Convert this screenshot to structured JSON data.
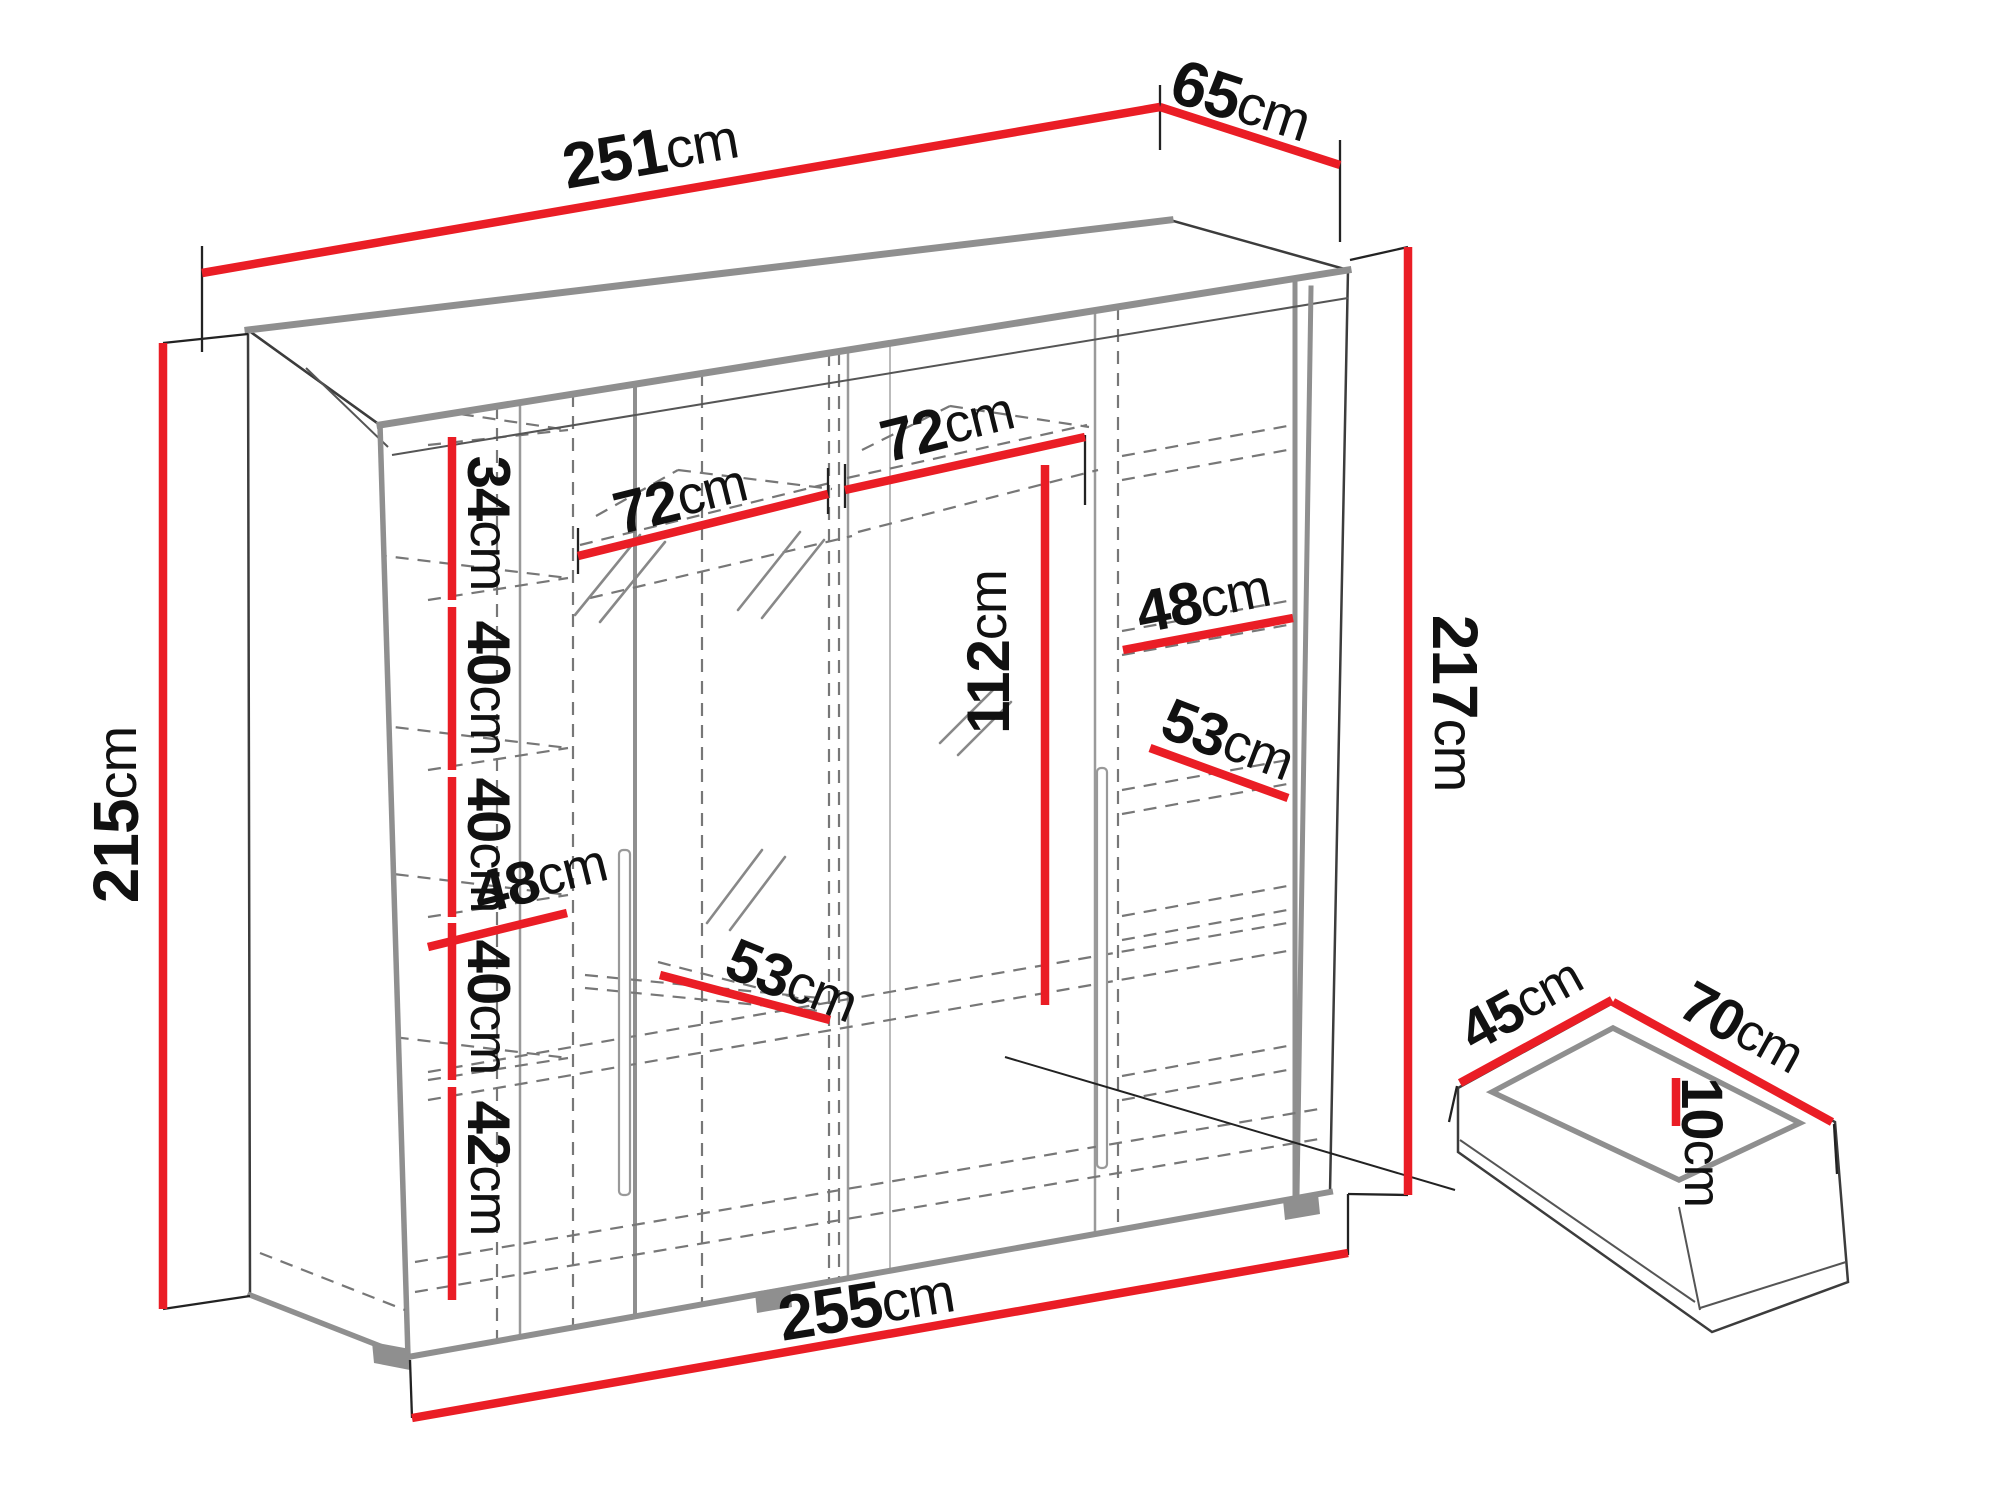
{
  "figure": {
    "type": "furniture dimension diagram",
    "subject": "sliding-door wardrobe with interior shelves and a separate drawer"
  },
  "colors": {
    "dimension_red": "#ea1d25",
    "edge_gray": "#8f8f8f",
    "line_dark": "#3c3c3c",
    "dash_gray": "#777777",
    "background": "#ffffff"
  },
  "wardrobe": {
    "top_width": "251cm",
    "top_depth": "65cm",
    "height_left": "215cm",
    "height_right": "217cm",
    "bottom_width": "255cm",
    "left_column_sections": [
      "34cm",
      "40cm",
      "40cm",
      "40cm",
      "42cm"
    ],
    "section_widths": [
      "72cm",
      "72cm"
    ],
    "hanging_space_height": "112cm",
    "left_interior_depths": [
      "48cm",
      "53cm"
    ],
    "right_interior_depths": [
      "48cm",
      "53cm"
    ]
  },
  "drawer": {
    "depth": "45cm",
    "width": "70cm",
    "height": "10cm"
  },
  "dims": {
    "w251": {
      "num": "251",
      "unit": "cm"
    },
    "d65": {
      "num": "65",
      "unit": "cm"
    },
    "h215": {
      "num": "215",
      "unit": "cm"
    },
    "h217": {
      "num": "217",
      "unit": "cm"
    },
    "w255": {
      "num": "255",
      "unit": "cm"
    },
    "s34": {
      "num": "34",
      "unit": "cm"
    },
    "s40a": {
      "num": "40",
      "unit": "cm"
    },
    "s40b": {
      "num": "40",
      "unit": "cm"
    },
    "s40c": {
      "num": "40",
      "unit": "cm"
    },
    "s42": {
      "num": "42",
      "unit": "cm"
    },
    "i48l": {
      "num": "48",
      "unit": "cm"
    },
    "i53l": {
      "num": "53",
      "unit": "cm"
    },
    "w72a": {
      "num": "72",
      "unit": "cm"
    },
    "w72b": {
      "num": "72",
      "unit": "cm"
    },
    "h112": {
      "num": "112",
      "unit": "cm"
    },
    "i48r": {
      "num": "48",
      "unit": "cm"
    },
    "i53r": {
      "num": "53",
      "unit": "cm"
    },
    "dr45": {
      "num": "45",
      "unit": "cm"
    },
    "dr70": {
      "num": "70",
      "unit": "cm"
    },
    "dr10": {
      "num": "10",
      "unit": "cm"
    }
  }
}
